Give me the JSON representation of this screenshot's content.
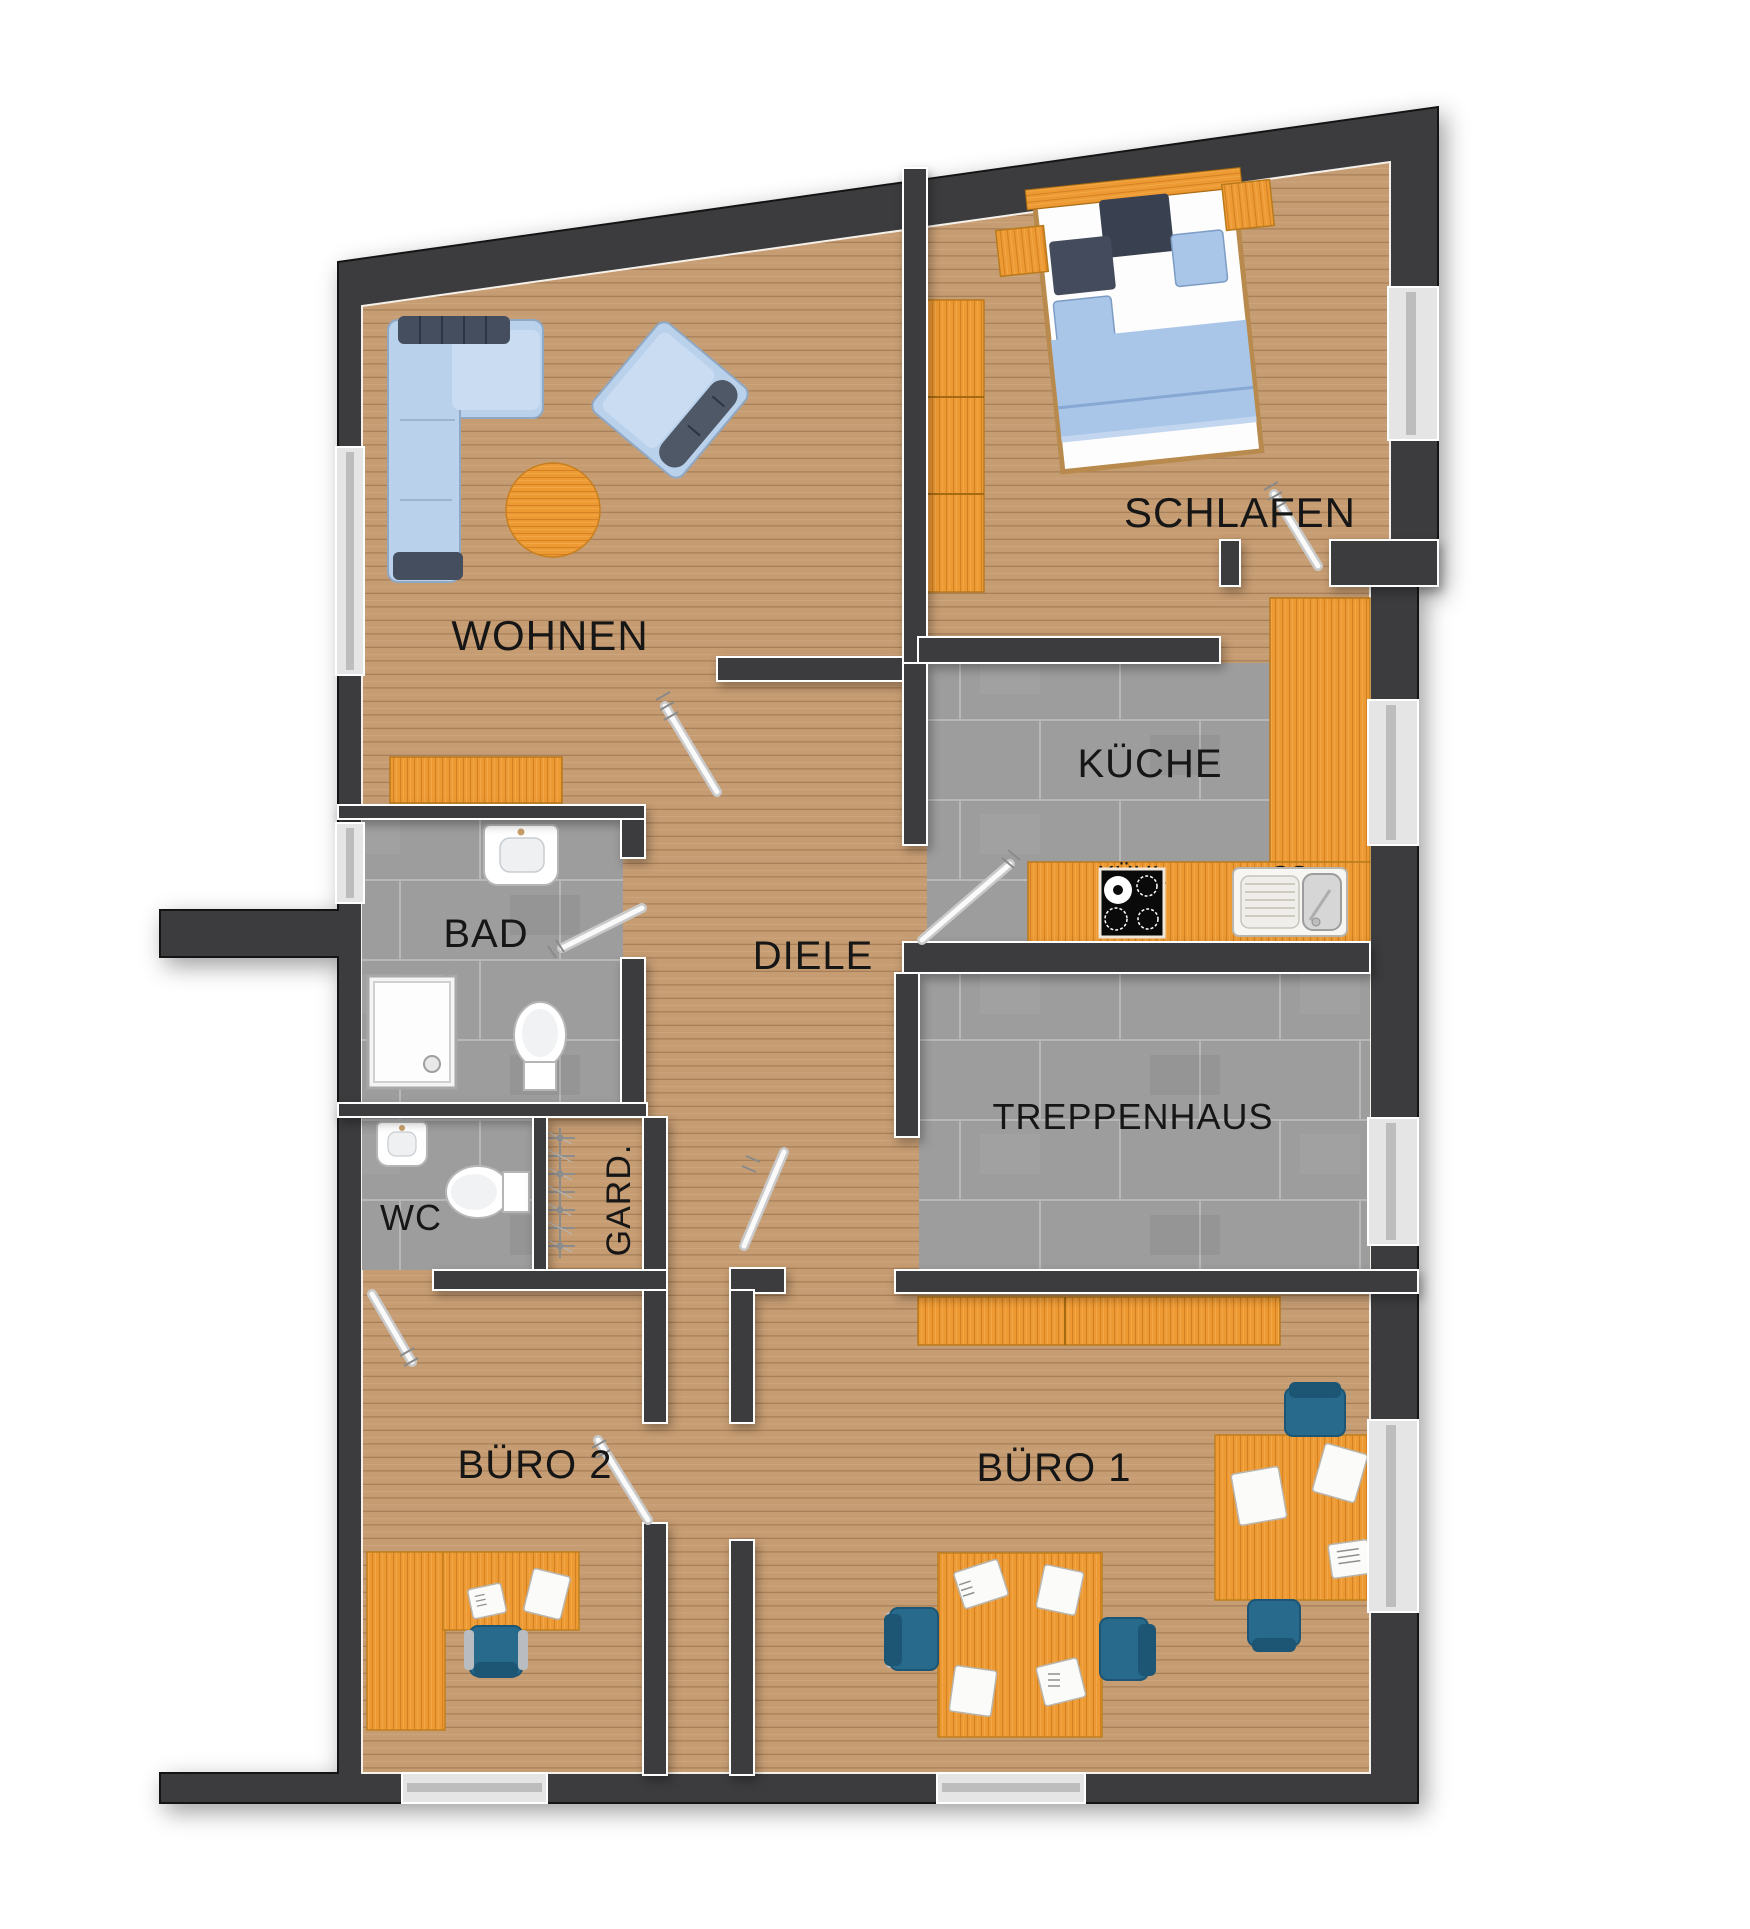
{
  "plan": {
    "rooms": [
      {
        "name": "wohnen",
        "label": "WOHNEN"
      },
      {
        "name": "schlafen",
        "label": "SCHLAFEN"
      },
      {
        "name": "kueche",
        "label": "KÜCHE"
      },
      {
        "name": "bad",
        "label": "BAD"
      },
      {
        "name": "diele",
        "label": "DIELE"
      },
      {
        "name": "treppenhaus",
        "label": "TREPPENHAUS"
      },
      {
        "name": "wc",
        "label": "WC"
      },
      {
        "name": "garderobe",
        "label": "GARD."
      },
      {
        "name": "buero2",
        "label": "BÜRO 2"
      },
      {
        "name": "buero1",
        "label": "BÜRO 1"
      }
    ],
    "appliances": [
      {
        "name": "fridge",
        "label": "KÜHL"
      },
      {
        "name": "dishwasher",
        "label": "GS"
      }
    ],
    "colors": {
      "wall": "#3c3c3e",
      "wood_floor": "#c69c72",
      "tile_floor": "#9d9d9d",
      "furniture_orange": "#ee9a33",
      "sofa_blue": "#bad1ec",
      "cushion_dark": "#454e5e",
      "blanket_blue": "#a9c6e9",
      "chair_teal": "#276a8c",
      "window_glass": "#e5e5e5",
      "label_text": "#161616"
    }
  }
}
